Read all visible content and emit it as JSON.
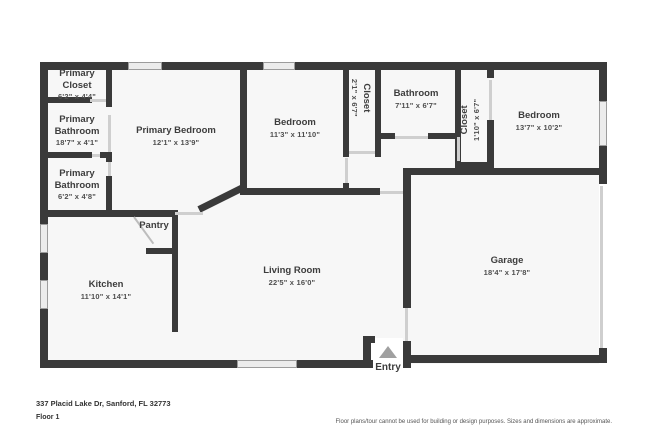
{
  "floor_plan": {
    "rooms": [
      {
        "name": "Primary Closet",
        "dims": "6'2\" x 4'4\""
      },
      {
        "name": "Primary Bathroom",
        "dims": "18'7\" x 4'1\""
      },
      {
        "name": "Primary Bathroom",
        "dims": "6'2\" x 4'8\""
      },
      {
        "name": "Primary Bedroom",
        "dims": "12'1\" x 13'9\""
      },
      {
        "name": "Bedroom",
        "dims": "11'3\" x 11'10\""
      },
      {
        "name": "Closet",
        "dims": "2'1\" x 6'7\""
      },
      {
        "name": "Bathroom",
        "dims": "7'11\" x 6'7\""
      },
      {
        "name": "Closet",
        "dims": "1'10\" x 6'7\""
      },
      {
        "name": "Bedroom",
        "dims": "13'7\" x 10'2\""
      },
      {
        "name": "Pantry",
        "dims": ""
      },
      {
        "name": "Kitchen",
        "dims": "11'10\" x 14'1\""
      },
      {
        "name": "Living Room",
        "dims": "22'5\" x 16'0\""
      },
      {
        "name": "Garage",
        "dims": "18'4\" x 17'8\""
      },
      {
        "name": "Entry",
        "dims": ""
      }
    ],
    "entry_label": "Entry"
  },
  "footer": {
    "address": "337 Placid Lake Dr, Sanford, FL 32773",
    "floor": "Floor 1",
    "disclaimer": "Floor plans/tour cannot be used for building or design purposes. Sizes and dimensions are approximate."
  },
  "colors": {
    "wall": "#3a3a3a",
    "room_fill": "#f7f7f7",
    "window": "#ececec",
    "door_opening": "#cfcfcf",
    "entry_arrow": "#a0a0a0",
    "text": "#3d3d3d"
  }
}
